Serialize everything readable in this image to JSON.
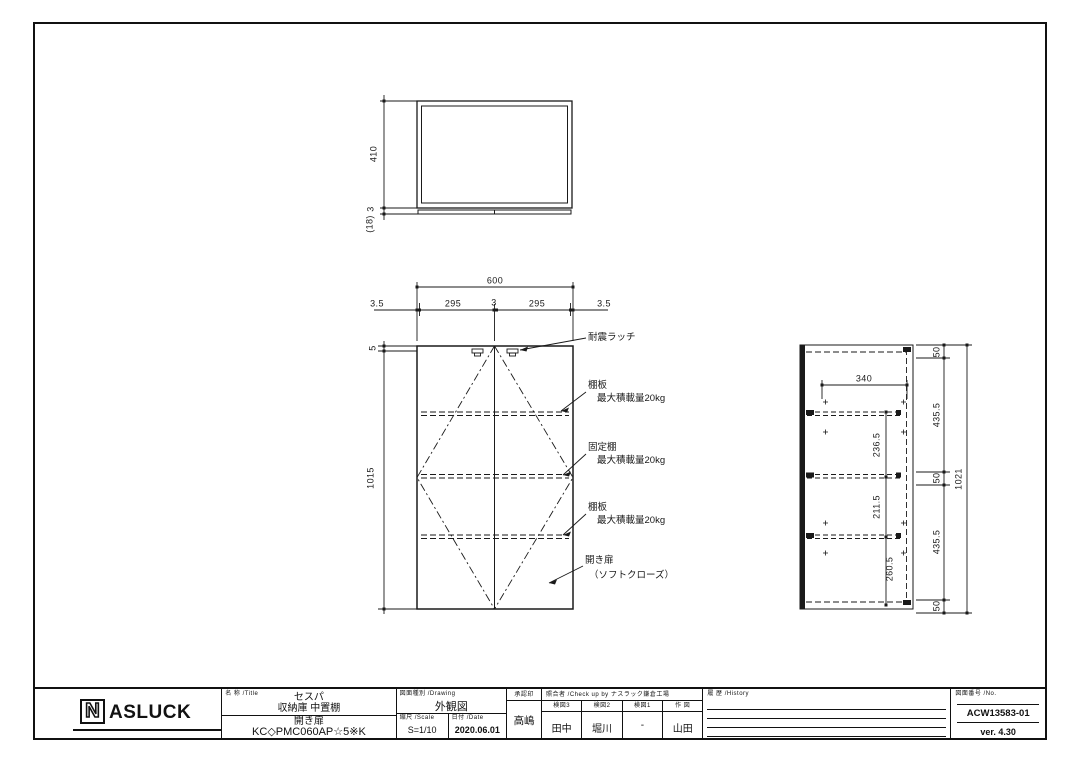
{
  "dims": {
    "top_depth": "410",
    "top_gap": "3",
    "top_door": "(18)",
    "front_width": "600",
    "front_m1": "3.5",
    "front_p1": "295",
    "front_gap": "3",
    "front_p2": "295",
    "front_m2": "3.5",
    "front_top": "5",
    "front_height": "1015",
    "side_width": "340",
    "side_s1": "236.5",
    "side_s2": "211.5",
    "side_s3": "260.5",
    "side_c1": "50",
    "side_c2": "435.5",
    "side_c3": "50",
    "side_c4": "435.5",
    "side_c5": "50",
    "side_height": "1021"
  },
  "callouts": {
    "latch": "耐震ラッチ",
    "shelf1_line1": "棚板",
    "shelf1_line2": "最大積載量20kg",
    "fixed_line1": "固定棚",
    "fixed_line2": "最大積載量20kg",
    "shelf2_line1": "棚板",
    "shelf2_line2": "最大積載量20kg",
    "door_line1": "開き扉",
    "door_line2": "（ソフトクローズ）"
  },
  "title_block": {
    "logo": {
      "n": "N",
      "rest": "ASLUCK"
    },
    "title": {
      "header": "名 称 /Title",
      "line1": "セスパ",
      "line2": "収納庫 中置棚",
      "line3": "開き扉",
      "line4": "KC◇PMC060AP☆5※K"
    },
    "drawing": {
      "header": "図面種別 /Drawing",
      "value": "外観図",
      "scale_header": "縮尺 /Scale",
      "scale": "S=1/10",
      "date_header": "日付 /Date",
      "date": "2020.06.01"
    },
    "approval": {
      "header": "承認印",
      "value": "高嶋"
    },
    "check": {
      "header": "照合者 /Check up by ナスラック鎌倉工場",
      "cols": [
        {
          "h": "検図3",
          "v": "田中"
        },
        {
          "h": "検図2",
          "v": "堀川"
        },
        {
          "h": "検図1",
          "v": "-"
        },
        {
          "h": "作 図",
          "v": "山田"
        }
      ]
    },
    "history": {
      "header": "履 歴 /History"
    },
    "number": {
      "header": "図面番号 /No.",
      "value": "ACW13583-01",
      "version": "ver. 4.30"
    }
  }
}
